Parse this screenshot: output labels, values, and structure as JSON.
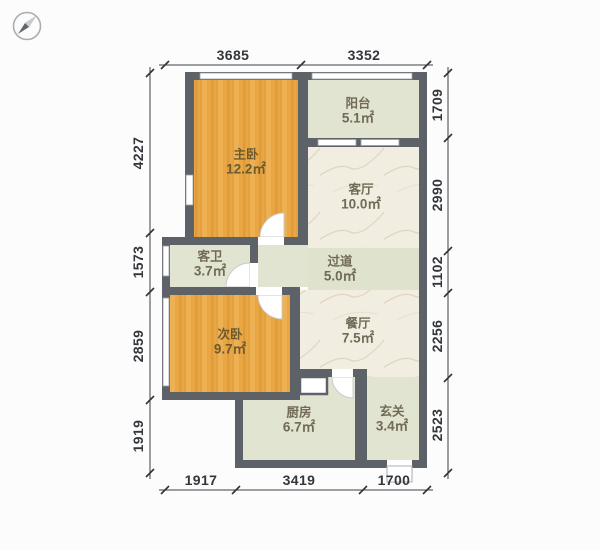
{
  "plan": {
    "type": "apartment-floor-plan",
    "compass_icon": "compass-needle-pointing-northeast",
    "rooms": [
      {
        "id": "master-bedroom",
        "name": "主卧",
        "area": "12.2㎡"
      },
      {
        "id": "balcony",
        "name": "阳台",
        "area": "5.1㎡"
      },
      {
        "id": "living-room",
        "name": "客厅",
        "area": "10.0㎡"
      },
      {
        "id": "guest-bathroom",
        "name": "客卫",
        "area": "3.7㎡"
      },
      {
        "id": "hallway",
        "name": "过道",
        "area": "5.0㎡"
      },
      {
        "id": "second-bedroom",
        "name": "次卧",
        "area": "9.7㎡"
      },
      {
        "id": "dining-room",
        "name": "餐厅",
        "area": "7.5㎡"
      },
      {
        "id": "kitchen",
        "name": "厨房",
        "area": "6.7㎡"
      },
      {
        "id": "entryway",
        "name": "玄关",
        "area": "3.4㎡"
      }
    ],
    "dimensions_mm": {
      "top": [
        "3685",
        "3352"
      ],
      "left": [
        "4227",
        "1573",
        "2859",
        "1919"
      ],
      "right": [
        "1709",
        "2990",
        "1102",
        "2256",
        "2523"
      ],
      "bottom": [
        "1917",
        "3419",
        "1700"
      ]
    },
    "colors": {
      "wall": "#5d6168",
      "bedroom_floor": "#e9a642",
      "tile_floor": "#e1e4d0",
      "marble_floor": "#f1ede0",
      "dimension_text": "#33363b",
      "background": "#fcfcfc"
    }
  }
}
